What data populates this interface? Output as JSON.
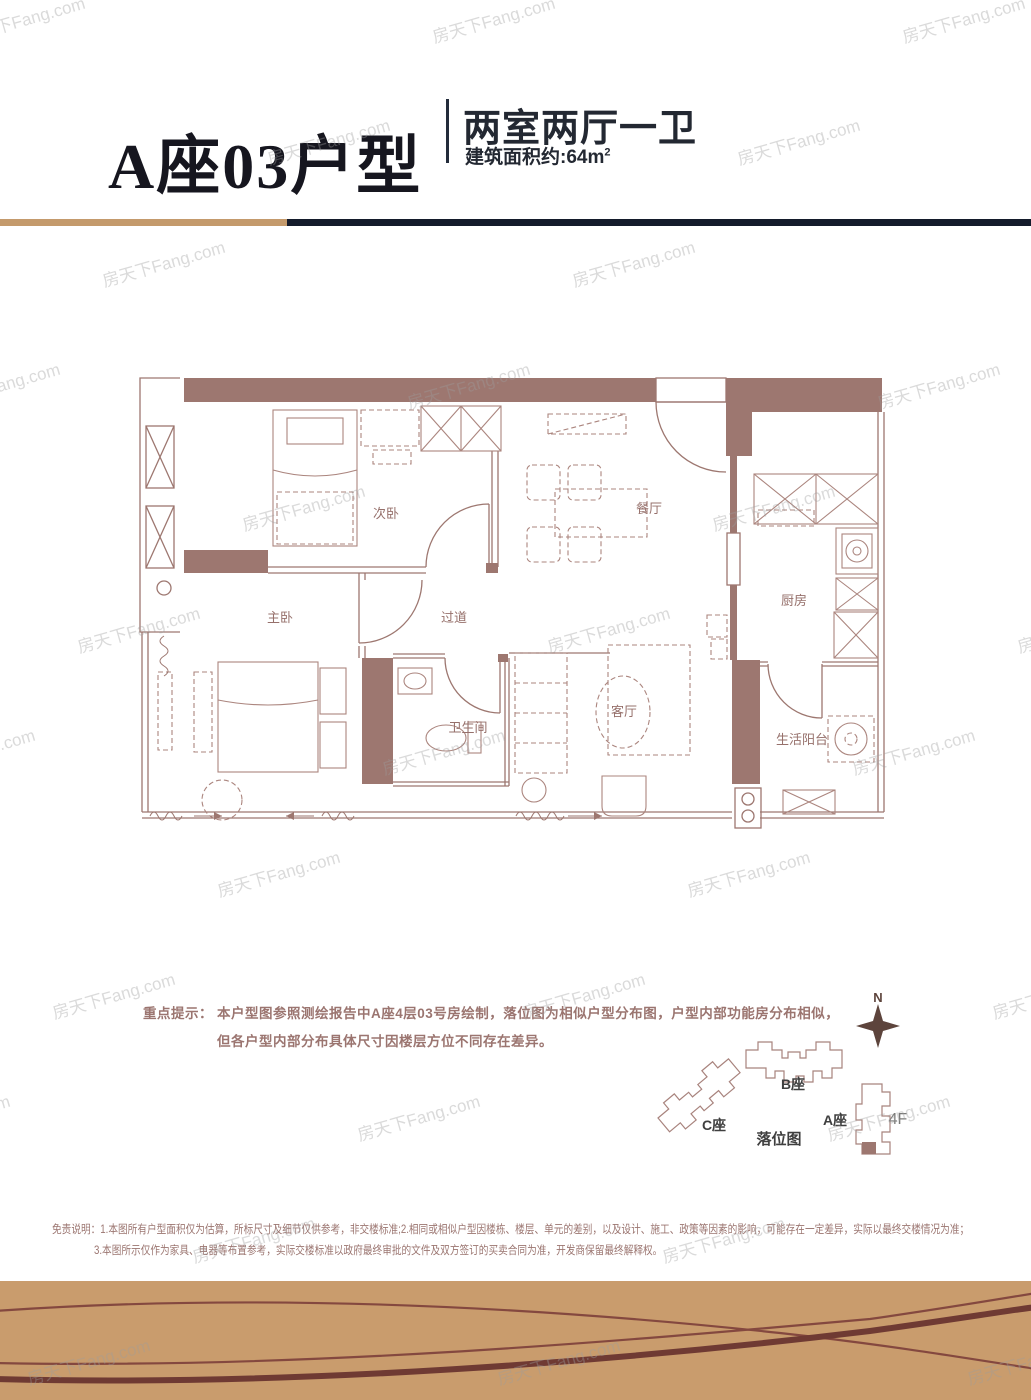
{
  "watermark": {
    "text": "房天下Fang.com"
  },
  "header": {
    "title": "A座03户型",
    "spec": "两室两厅一卫",
    "area_prefix": "建筑面积约:64m",
    "area_sup": "2"
  },
  "floorplan": {
    "rooms": [
      {
        "id": "second-bedroom",
        "label": "次卧"
      },
      {
        "id": "dining-room",
        "label": "餐厅"
      },
      {
        "id": "kitchen",
        "label": "厨房"
      },
      {
        "id": "master-bedroom",
        "label": "主卧"
      },
      {
        "id": "hallway",
        "label": "过道"
      },
      {
        "id": "bathroom",
        "label": "卫生间"
      },
      {
        "id": "living-room",
        "label": "客厅"
      },
      {
        "id": "utility-balcony",
        "label": "生活阳台"
      }
    ]
  },
  "notice": {
    "label": "重点提示：",
    "line1": "本户型图参照测绘报告中A座4层03号房绘制，落位图为相似户型分布图，户型内部功能房分布相似，",
    "line2": "但各户型内部分布具体尺寸因楼层方位不同存在差异。"
  },
  "sitemap": {
    "north": "N",
    "building_b": "B座",
    "building_c": "C座",
    "building_a": "A座",
    "floor": "4F",
    "caption": "落位图"
  },
  "disclaimer": {
    "line1": "免责说明：1.本图所有户型面积仅为估算，所标尺寸及细节仅供参考，非交楼标准;2.相同或相似户型因楼栋、楼层、单元的差别，以及设计、施工、政策等因素的影响，可能存在一定差异，实际以最终交楼情况为准；",
    "line2": "3.本图所示仅作为家具、电器等布置参考，实际交楼标准以政府最终审批的文件及双方签订的买卖合同为准，开发商保留最终解释权。"
  },
  "colors": {
    "wall": "#9d7770",
    "gold_accent": "#c49a6c",
    "header_dark": "#141b2b",
    "band": "#c99c6d",
    "band_curve": "#7d4238",
    "note_text": "#9b7570"
  }
}
